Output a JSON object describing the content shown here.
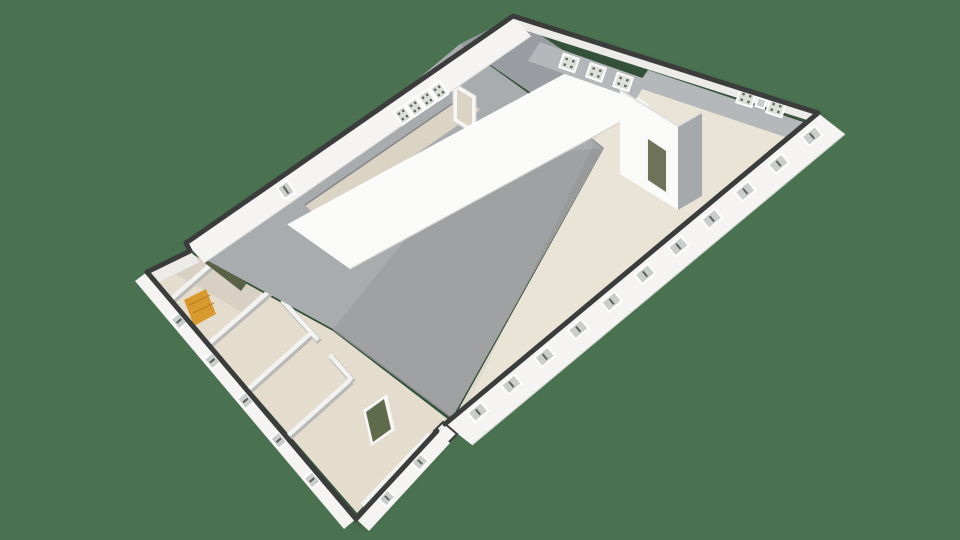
{
  "app": {
    "name": "3d-floorplan-viewer",
    "description": "Isometric 3D dollhouse floor plan of a long industrial hall with a small-room annex, rendered on a plain green background"
  },
  "scene": {
    "background_color": "#4A7150",
    "shadow_color": "#1F2F24",
    "view": "3d-dollhouse",
    "has_text": false
  },
  "building": {
    "type": "industrial-hall-with-annex",
    "colors": {
      "floor": "#E4DDCE",
      "floor_light": "#EAE4D6",
      "floor_corridor": "#DBD4C5",
      "wall_white": "#F5F4F2",
      "wall_bright": "#FAFAF9",
      "wall_inner_lip": "#ECEBE9",
      "wall_shaded": "#B5B8BA",
      "wall_shaded_dark": "#A6A9AB",
      "roof": "#A9ACAE",
      "roof_dark": "#999CA0",
      "outline": "#3A3D3C",
      "interior_wall": "#F2F2F0",
      "interior_wall_edge": "#B9B9B7",
      "door_green": "#5F6B4A",
      "door_frame": "#F7F6F4",
      "stairs_orange": "#D8992F",
      "stairs_dark_olive": "#5B6147",
      "toilet_white": "#FDFDFC",
      "window_frame": "#FFFFFF",
      "window_glass": "#C9CDCB",
      "window_glass_light": "#DDDFD9",
      "window_mullion": "#5E635B"
    },
    "windows": {
      "se_wall_count": 11,
      "nw_wall_group_count": 4,
      "nw_wall_single_count": 1,
      "annex_sw_count": 5,
      "annex_se_count": 2,
      "gable_grid_count": 3,
      "ne_grid_count": 2,
      "ne_small_count": 1
    },
    "features": [
      "main hall with beige floor",
      "tall white dividing wall",
      "gray pitched roof over mid section",
      "annex of small rooms at lower left",
      "orange staircase",
      "dark olive staircase",
      "toilet fixture",
      "green door into annex room",
      "interior corner wall with door near east end"
    ]
  },
  "labels": {
    "floorplan": "3D floor plan viewport",
    "main_hall": "Main hall floor",
    "corridor": "Corridor floor strip",
    "dividing_wall": "Central dividing wall",
    "roof_main": "Pitched roof plane",
    "roof_gable": "Gable roof plane",
    "annex": "Annex rooms",
    "annex_floor": "Annex floor",
    "corner_wall": "Interior corner wall",
    "corner_door": "Interior door",
    "green_door": "Green door",
    "orange_stairs": "Staircase (orange)",
    "dark_stairs": "Staircase (dark)",
    "toilet": "Toilet fixture",
    "doorway": "Door opening",
    "nw_wall": "North-west exterior wall",
    "ne_wall": "North-east exterior wall",
    "se_wall": "South-east exterior wall",
    "window": "Window"
  }
}
